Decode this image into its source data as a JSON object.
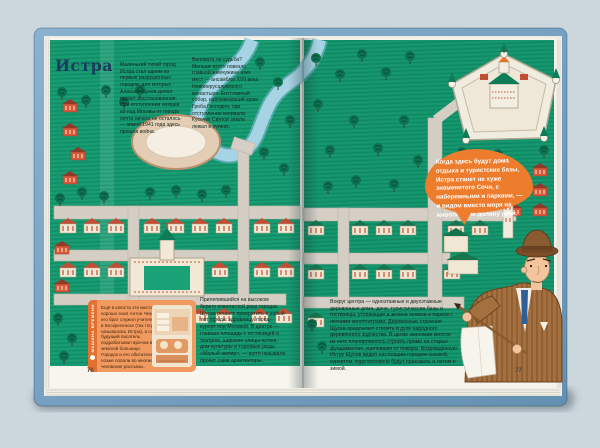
{
  "book": {
    "colors": {
      "background": "#ccd7dd",
      "cover_blue": "#7ba6c8",
      "page_green": "#14996f",
      "accent_orange": "#ed7c2c",
      "info_box_orange": "#f19a5f",
      "title_navy": "#1d3a5f"
    },
    "left_page": {
      "page_number": "76",
      "title": "Истра",
      "intro_col_1": "Маленький тихий город Истра стал одним из первых разрушенных городов, для которых Алексей Щусев делал проект восстановления. При отступлении немцев из-под Москвы от города почти ничего не осталось — зимой 1941 года здесь прошла война.",
      "intro_col_2": "Виновата ли судьба? Меньше всего повезло главной жемчужине этих мест — ансамблю XVII века Новоиерусалимского монастыря. Его главный собор, напоминавший храм Гроба Господня, при отступлении взорвали. Кусочек Святой земли лежал в руинах.",
      "plan_paragraph": "Прилепившийся на высоком берегу извилистой реки городок Щусев решает превратить в новый тип города: здравницу, город-курорт под Москвой. В центре — главная площадь с гостиницей и театром, широкие улицы-аллеи, дом культуры и торговые ряды. «Малый ампир», — шутя называли проект сами архитекторы.",
      "info_box": {
        "rubric": "МАШИНА ВРЕМЕНИ",
        "text": "Ещё в юности эти места хорошо знал Антон Чехов: его брат служил учителем в Воскресенске (так тогда называлась Истра), а сам будущий писатель подрабатывал врачом в земской больнице. Городок и его обитатели позже попали во многие чеховские рассказы."
      }
    },
    "right_page": {
      "page_number": "77",
      "speech_bubble": "Когда здесь будут дома отдыха и туристские базы, Истра станет не хуже знаменитого Сочи, с набережными и парками, — и видом вместо моря на живописную долину реки.",
      "body_paragraph": "Вокруг центра — одноэтажные и двухэтажные деревянные дома, дачи, туристические базы и гостиницы, утопающие в зелени холмов и парков с летними кинотеатрами. Деревянные строения Щусев предлагает строить в духе народного деревянного зодчества. В целях экономии многое из него планировалось строить прямо на старых фундаментах, уцелевших от пожара. Возрождённую Истру Щусев видел настоящим городом-сказкой, курортом, куда москвичи будут приезжать и летом и зимой."
    }
  }
}
